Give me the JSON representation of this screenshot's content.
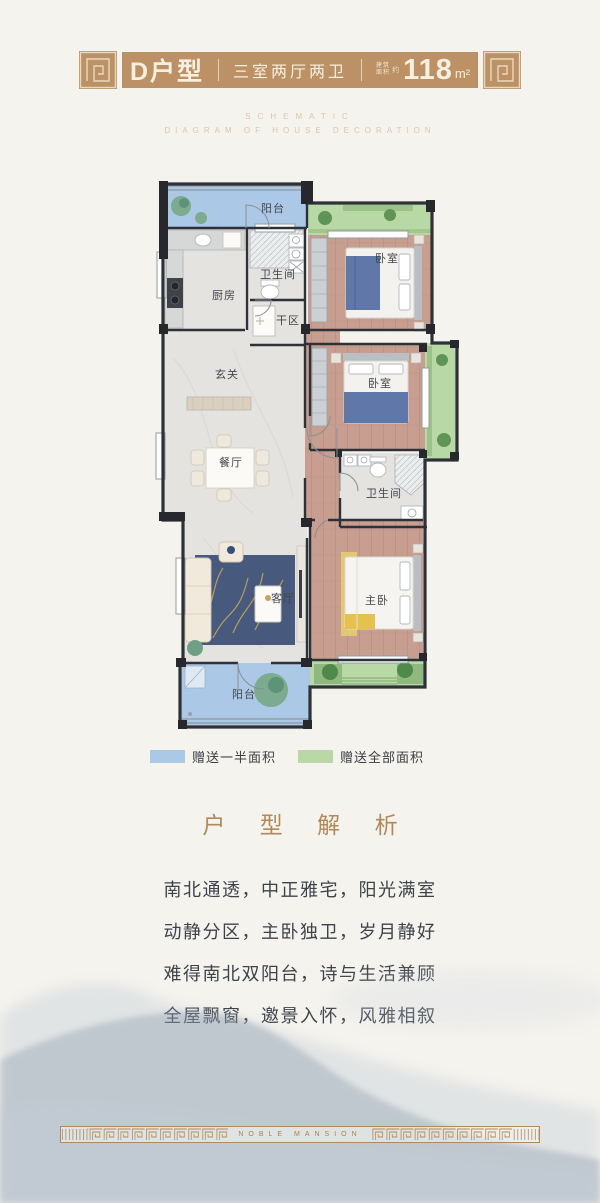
{
  "page": {
    "background": "#f5f3ee"
  },
  "header": {
    "unit": "D户型",
    "layout": "三室两厅两卫",
    "area_note_top": "建筑",
    "area_note_bottom": "面积",
    "area_approx": "约",
    "area_value": "118",
    "area_unit": "m²",
    "band_color": "#bb9165"
  },
  "subtitle": {
    "line1": "SCHEMATIC",
    "line2": "DIAGRAM OF HOUSE DECORATION"
  },
  "floorplan": {
    "labels": [
      {
        "text": "阳台"
      },
      {
        "text": "卫生间"
      },
      {
        "text": "厨房"
      },
      {
        "text": "干区"
      },
      {
        "text": "卧室"
      },
      {
        "text": "玄关"
      },
      {
        "text": "餐厅"
      },
      {
        "text": "卧室"
      },
      {
        "text": "卫生间"
      },
      {
        "text": "客厅"
      },
      {
        "text": "主卧"
      },
      {
        "text": "阳台"
      }
    ],
    "colors": {
      "balcony": "#abc9e6",
      "gift": "#b8d8a6",
      "wood": "#c79e90",
      "marble": "#e4e3e0",
      "wall": "#2f3138"
    }
  },
  "legend": {
    "items": [
      {
        "color": "#abc9e6",
        "label": "赠送一半面积"
      },
      {
        "color": "#b8d8a6",
        "label": "赠送全部面积"
      }
    ]
  },
  "analysis": {
    "title": "户 型 解 析",
    "lines": [
      "南北通透，中正雅宅，阳光满室",
      "动静分区，主卧独卫，岁月静好",
      "难得南北双阳台，诗与生活兼顾",
      "全屋飘窗，邀景入怀，风雅相叙"
    ]
  },
  "footer": {
    "brand": "NOBLE MANSION"
  }
}
